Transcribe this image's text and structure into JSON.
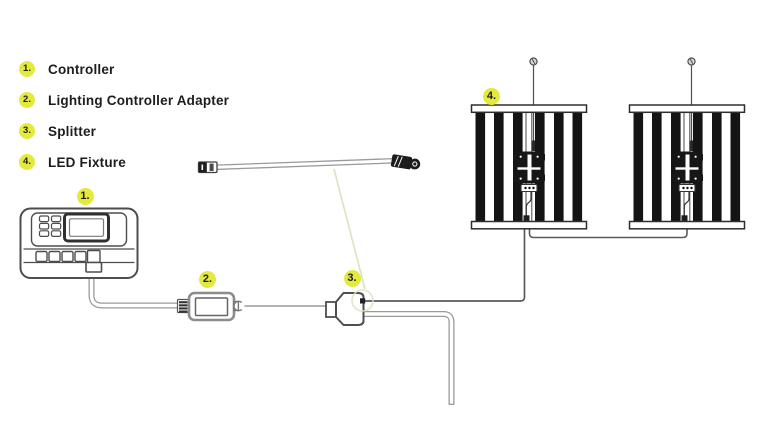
{
  "legend": {
    "items": [
      {
        "number": "1.",
        "label": "Controller"
      },
      {
        "number": "2.",
        "label": "Lighting Controller Adapter"
      },
      {
        "number": "3.",
        "label": "Splitter"
      },
      {
        "number": "4.",
        "label": "LED Fixture"
      }
    ]
  },
  "diagram": {
    "callouts": [
      {
        "number": "1.",
        "target": "Controller"
      },
      {
        "number": "2.",
        "target": "Lighting Controller Adapter"
      },
      {
        "number": "3.",
        "target": "Splitter"
      },
      {
        "number": "4.",
        "target": "LED Fixture"
      }
    ]
  },
  "colors": {
    "badge": "#e4ea3d",
    "text": "#1d1d1d",
    "line_art": "#4d4d4d",
    "cable_outline": "#9a9a9a",
    "leader_line": "#d9e4c2",
    "background": "#ffffff"
  }
}
